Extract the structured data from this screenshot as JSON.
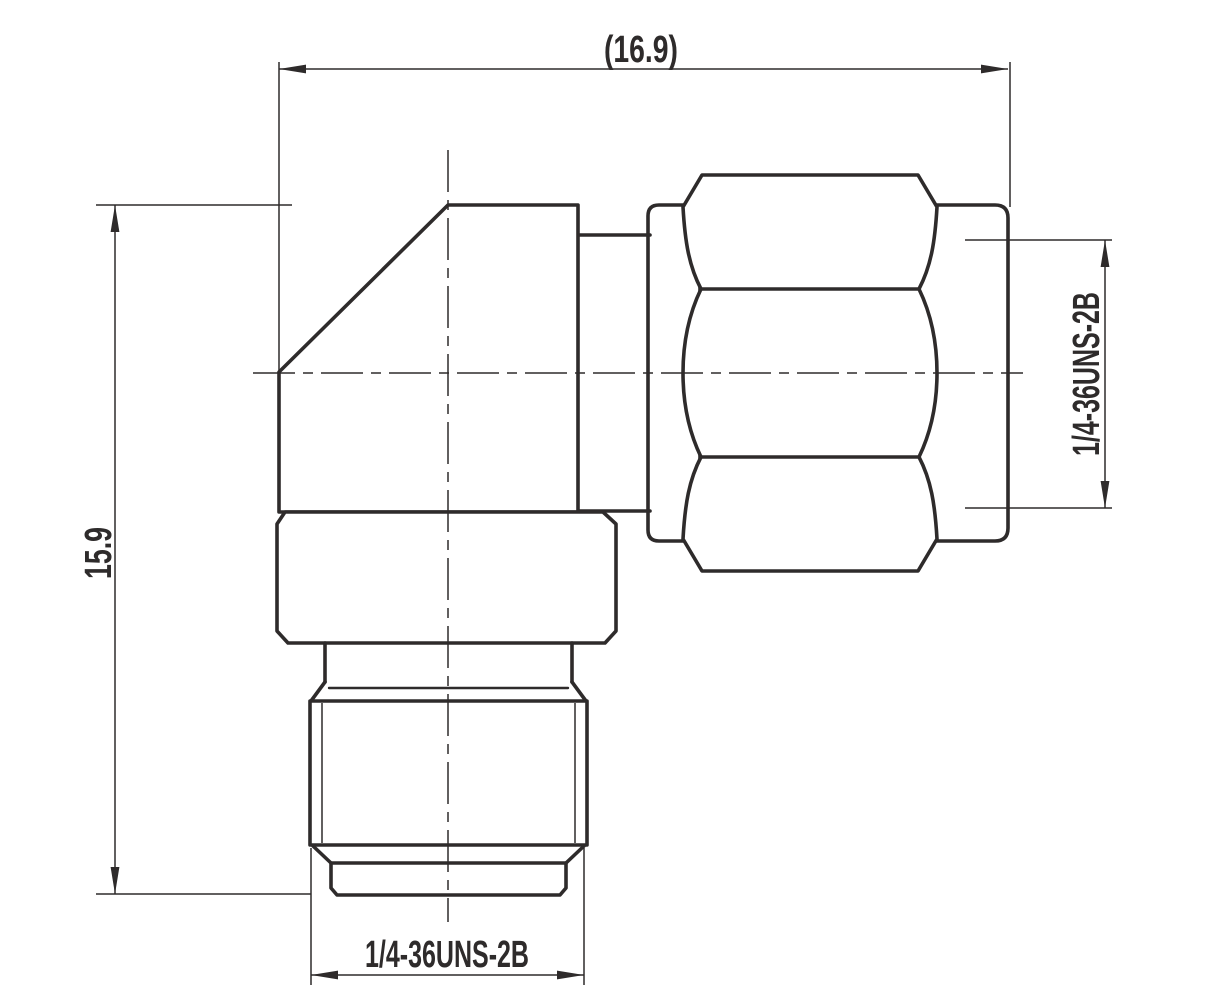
{
  "drawing": {
    "dimensions": {
      "overall_width": "(16.9)",
      "overall_height": "15.9",
      "right_thread": "1/4-36UNS-2B",
      "bottom_thread": "1/4-36UNS-2B"
    },
    "colors": {
      "line": "#2e2b2b",
      "background": "#ffffff"
    }
  }
}
